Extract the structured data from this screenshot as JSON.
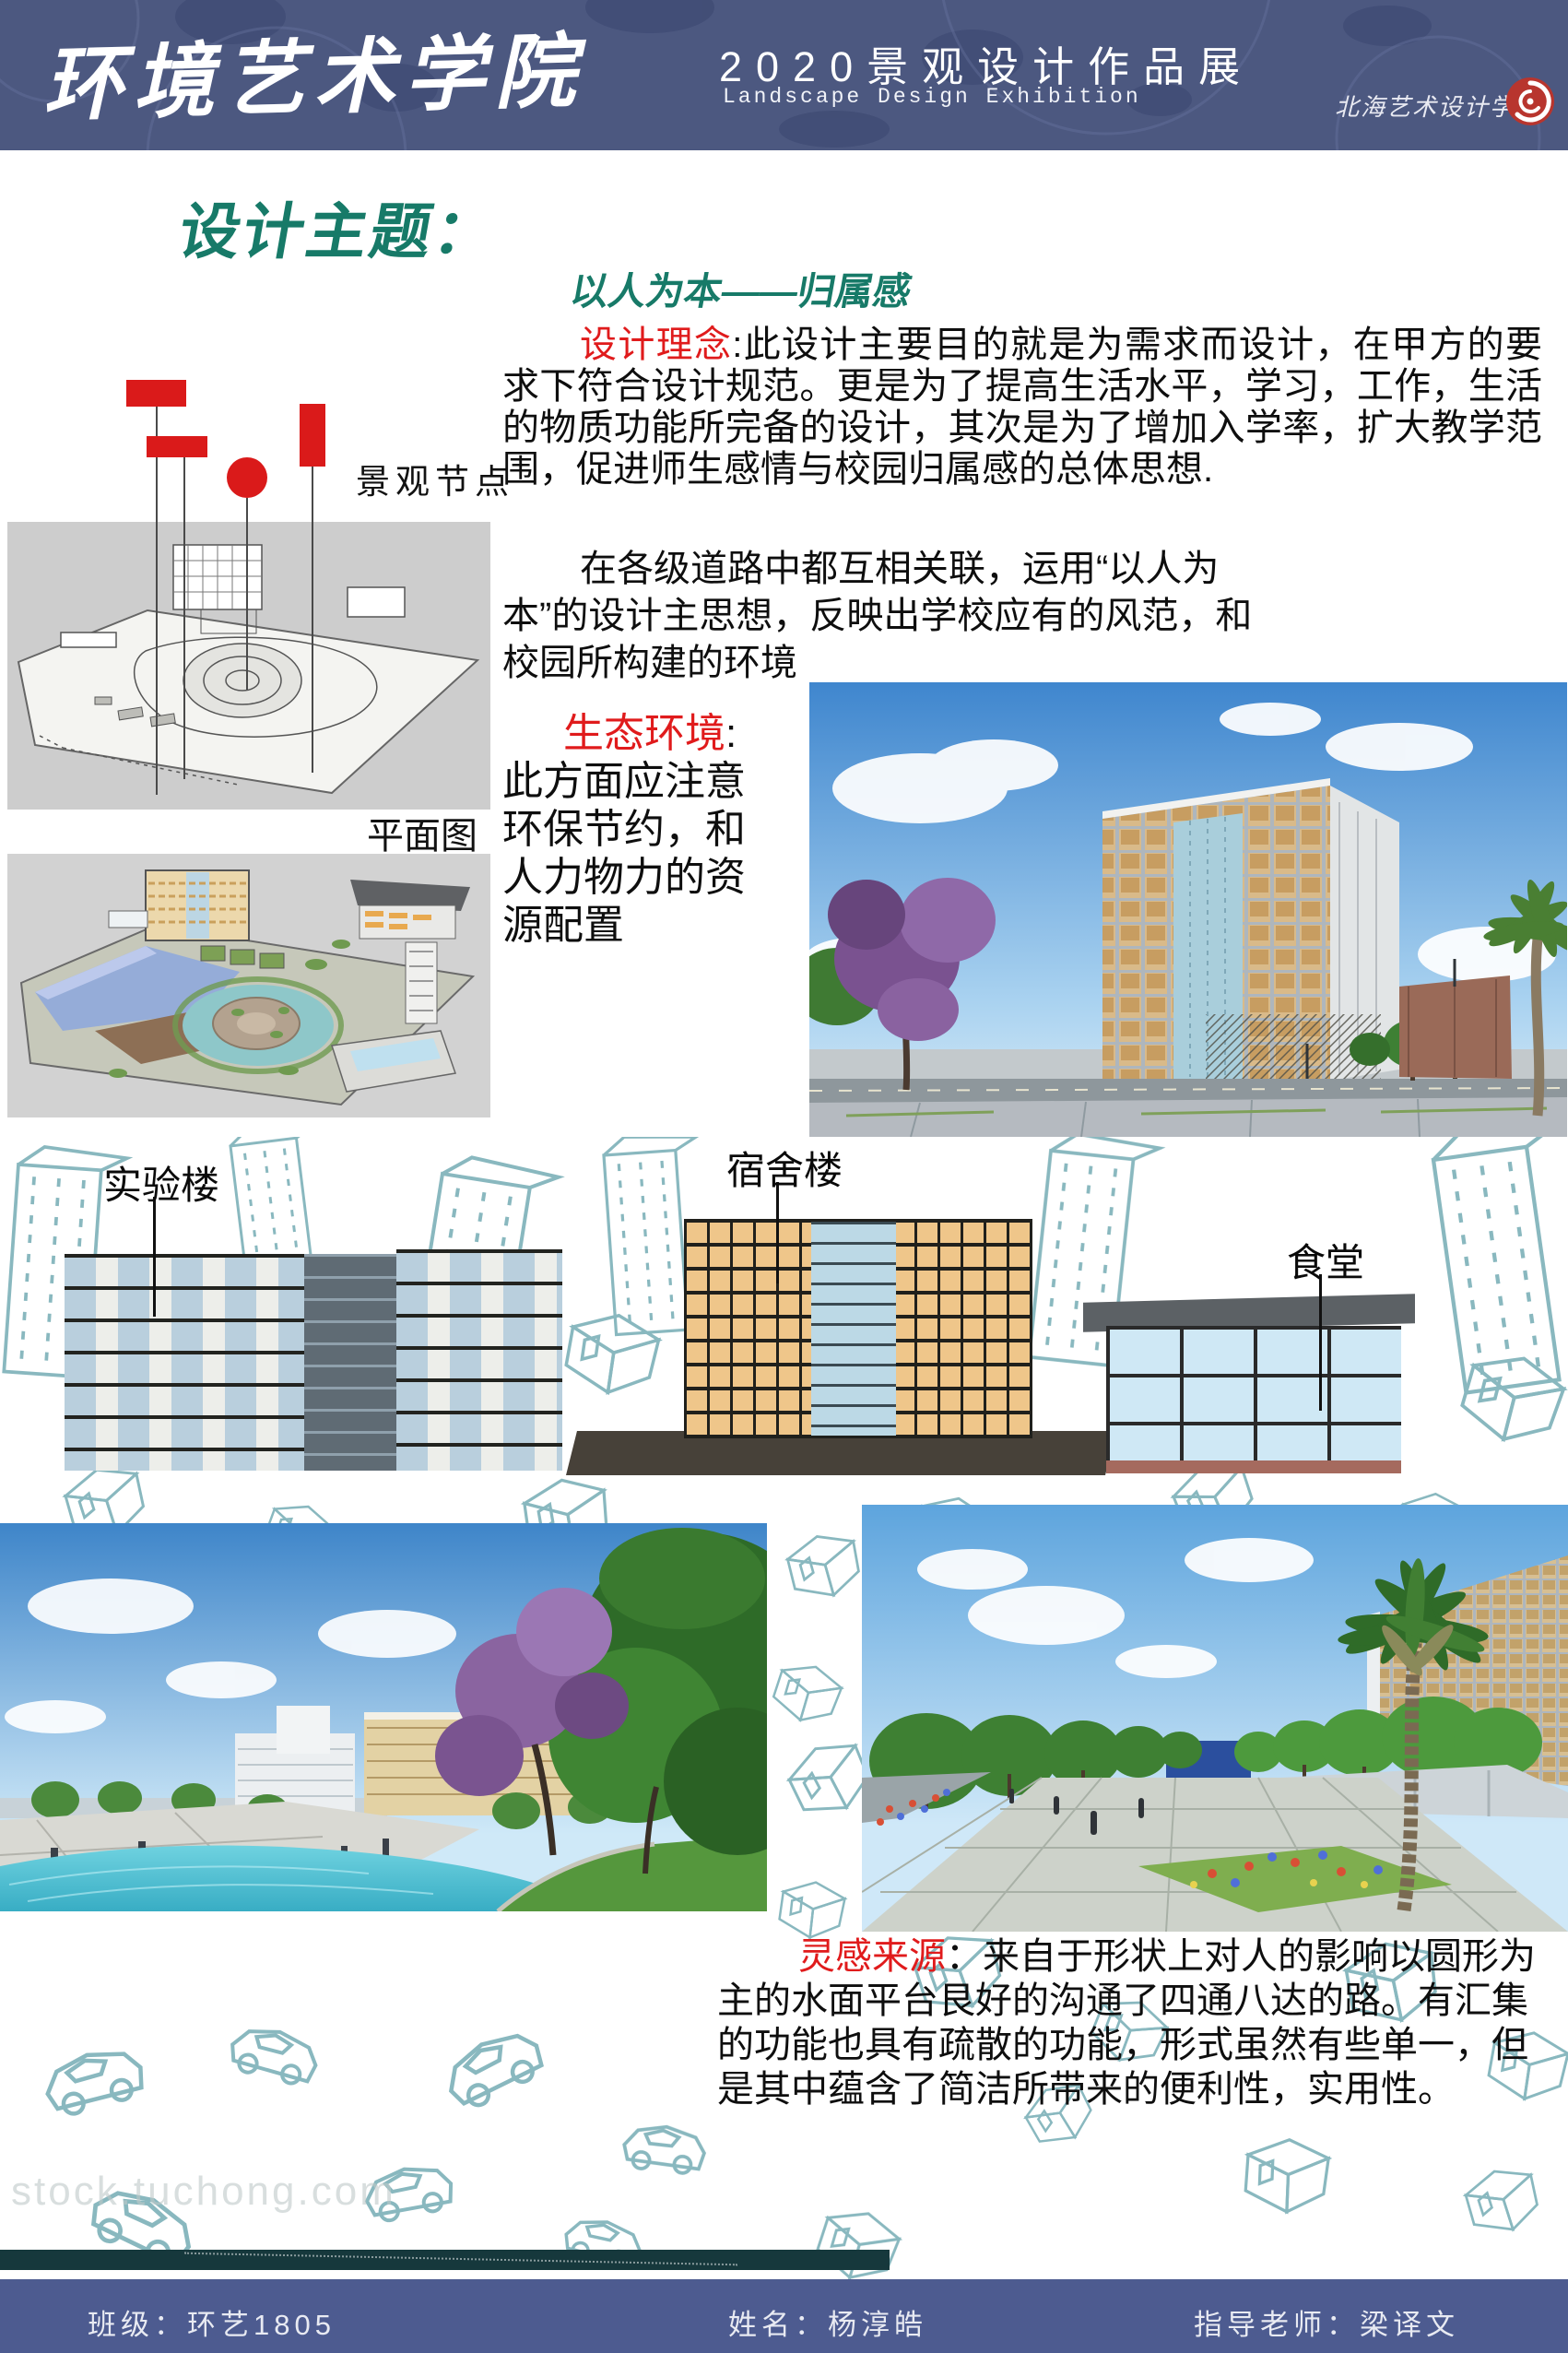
{
  "header": {
    "school_title": "环境艺术学院",
    "exhibition_title": "2020景观设计作品展",
    "exhibition_subtitle": "Landscape Design Exhibition",
    "institute_seal": "北海艺术设计学院"
  },
  "theme": {
    "heading": "设计主题：",
    "subheading": "以人为本——归属感"
  },
  "labels": {
    "landscape_nodes": "景观节点",
    "plan_view": "平面图",
    "lab_building": "实验楼",
    "dorm_building": "宿舍楼",
    "canteen": "食堂"
  },
  "paragraphs": {
    "concept": {
      "label": "设计理念",
      "text": ":此设计主要目的就是为需求而设计，在甲方的要求下符合设计规范。更是为了提高生活水平，学习，工作，生活的物质功能所完备的设计，其次是为了增加入学率，扩大教学范围，促进师生感情与校园归属感的总体思想."
    },
    "roads": {
      "text": "在各级道路中都互相关联，运用“以人为本”的设计主思想，反映出学校应有的风范，和校园所构建的环境"
    },
    "ecology": {
      "label": "生态环境",
      "text": ": 此方面应注意环保节约，和人力物力的资源配置"
    },
    "inspiration": {
      "label": "灵感来源",
      "text": "：来自于形状上对人的影响以圆形为主的水面平台艮好的沟通了四通八达的路。有汇集的功能也具有疏散的功能，形式虽然有些单一，但是其中蕴含了简洁所带来的便利性，实用性。"
    }
  },
  "watermark": "stock.tuchong.com",
  "footer": {
    "class_label": "班级：环艺1805",
    "name_label": "姓名：杨淳皓",
    "advisor_label": "指导老师：梁译文"
  },
  "colors": {
    "header_bg": "#4c5880",
    "footer_bg": "#4d5b90",
    "accent_teal": "#177a68",
    "accent_red": "#e01b1c",
    "wireframe_teal": "#49929c"
  }
}
